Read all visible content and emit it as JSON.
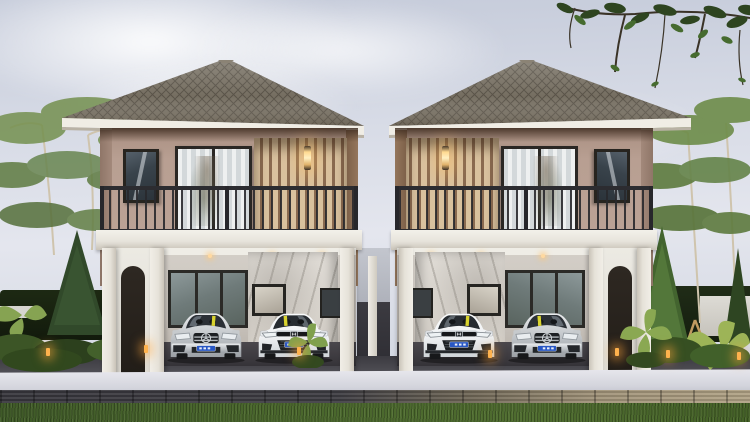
{
  "scene": {
    "type": "3d-architectural-exterior-render",
    "subject": "twin two-storey modern houses with stilt carports",
    "time_of_day": "daytime, overcast-bright sky",
    "label": "3D render of twin two-storey houses with carport parking, landscaped yard and street curb"
  },
  "palette": {
    "sky": "#dbe0e9",
    "roof_shingle": "#756e61",
    "fascia": "#f0ede5",
    "upper_wall": "#b89f92",
    "slat_accent": "#d9c19e",
    "slat_gap": "#8a6a50",
    "column_white": "#eeebe4",
    "railing": "#2c2c30",
    "marble_wall": "#dcd8d2",
    "driveway": "#46454b",
    "walkway": "#d8d8e0",
    "curb_dark": "#3b3a40",
    "curb_beige": "#a89a7f",
    "lawn": "#49662c",
    "foliage": "#55763a",
    "warm_light": "#ffd98f",
    "license_plate": "#2857c4"
  },
  "houses": [
    {
      "id": "left",
      "label": "Left twin house: hip roof, balcony with dark railing, glass sliding door, slat accent wall with lit sconce on inner side, carport below",
      "roof": "hip",
      "sconce_on": true,
      "cars": [
        {
          "brand_emblem": "mercedes-star",
          "body_color": "silver",
          "plate_color": "#2857c4",
          "label": "Silver Mercedes sedan parked in left carport"
        },
        {
          "brand_emblem": "honda-h",
          "body_color": "white",
          "plate_color": "#2857c4",
          "label": "White Honda Civic parked in left carport"
        }
      ]
    },
    {
      "id": "right",
      "label": "Right twin house: mirrored copy of left house, sconce lit on inner side, carport below",
      "roof": "hip",
      "sconce_on": true,
      "cars": [
        {
          "brand_emblem": "honda-h",
          "body_color": "white",
          "plate_color": "#2857c4",
          "label": "White Honda Civic parked in right carport"
        },
        {
          "brand_emblem": "mercedes-star",
          "body_color": "silver",
          "plate_color": "#2857c4",
          "label": "Silver Mercedes sedan parked in right carport"
        }
      ]
    }
  ],
  "landscape": {
    "left_side": [
      "airy umbrella trees",
      "dark conifer shrub",
      "palm fronds",
      "young tree with wooden tripod support",
      "low hedge row",
      "dark boundary hedge with white rail"
    ],
    "right_side": [
      "tall umbrella trees",
      "bright conifer",
      "palm grass",
      "young tree with wooden support",
      "dark hedge wall",
      "white boundary wall"
    ],
    "overhanging_branch": "leafy branch entering from top-right corner with drooping twigs",
    "foreground": [
      "dark asphalt driveway",
      "light concrete walkway",
      "stone block curb (dark to beige)",
      "green lawn strip"
    ],
    "garden_bollard_lights_on": 7
  }
}
